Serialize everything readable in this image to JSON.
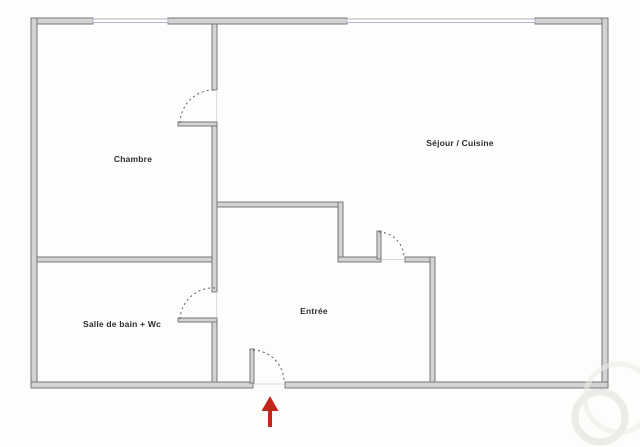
{
  "colors": {
    "background": "#fdfdfb",
    "wall_fill": "#d3d3d3",
    "wall_edge": "#777777",
    "window": "#b1b1ce",
    "door_arc": "#5a5a5a",
    "threshold": "#dcdcda",
    "entrance_arrow": "#c2271d",
    "label_text": "#2d2d2d",
    "watermark": "#ebebe8"
  },
  "rooms": [
    {
      "id": "chambre",
      "label": "Chambre"
    },
    {
      "id": "sejour-cuisine",
      "label": "Séjour / Cuisine"
    },
    {
      "id": "salle-de-bain-wc",
      "label": "Salle de bain + Wc"
    },
    {
      "id": "entree",
      "label": "Entrée"
    }
  ],
  "plan": {
    "type": "apartment-floor-plan",
    "windows": [
      {
        "wall": "top",
        "room": "Chambre"
      },
      {
        "wall": "top",
        "room": "Séjour / Cuisine"
      }
    ],
    "doors": [
      {
        "room": "Chambre",
        "style": "swing-arc"
      },
      {
        "room": "Salle de bain + Wc",
        "style": "swing-arc"
      },
      {
        "room": "Séjour / Cuisine",
        "style": "swing-arc"
      },
      {
        "room": "Entrée",
        "style": "swing-arc",
        "marker": "red-up-arrow"
      }
    ]
  },
  "icons": {
    "entrance_marker": "up-arrow-icon"
  }
}
